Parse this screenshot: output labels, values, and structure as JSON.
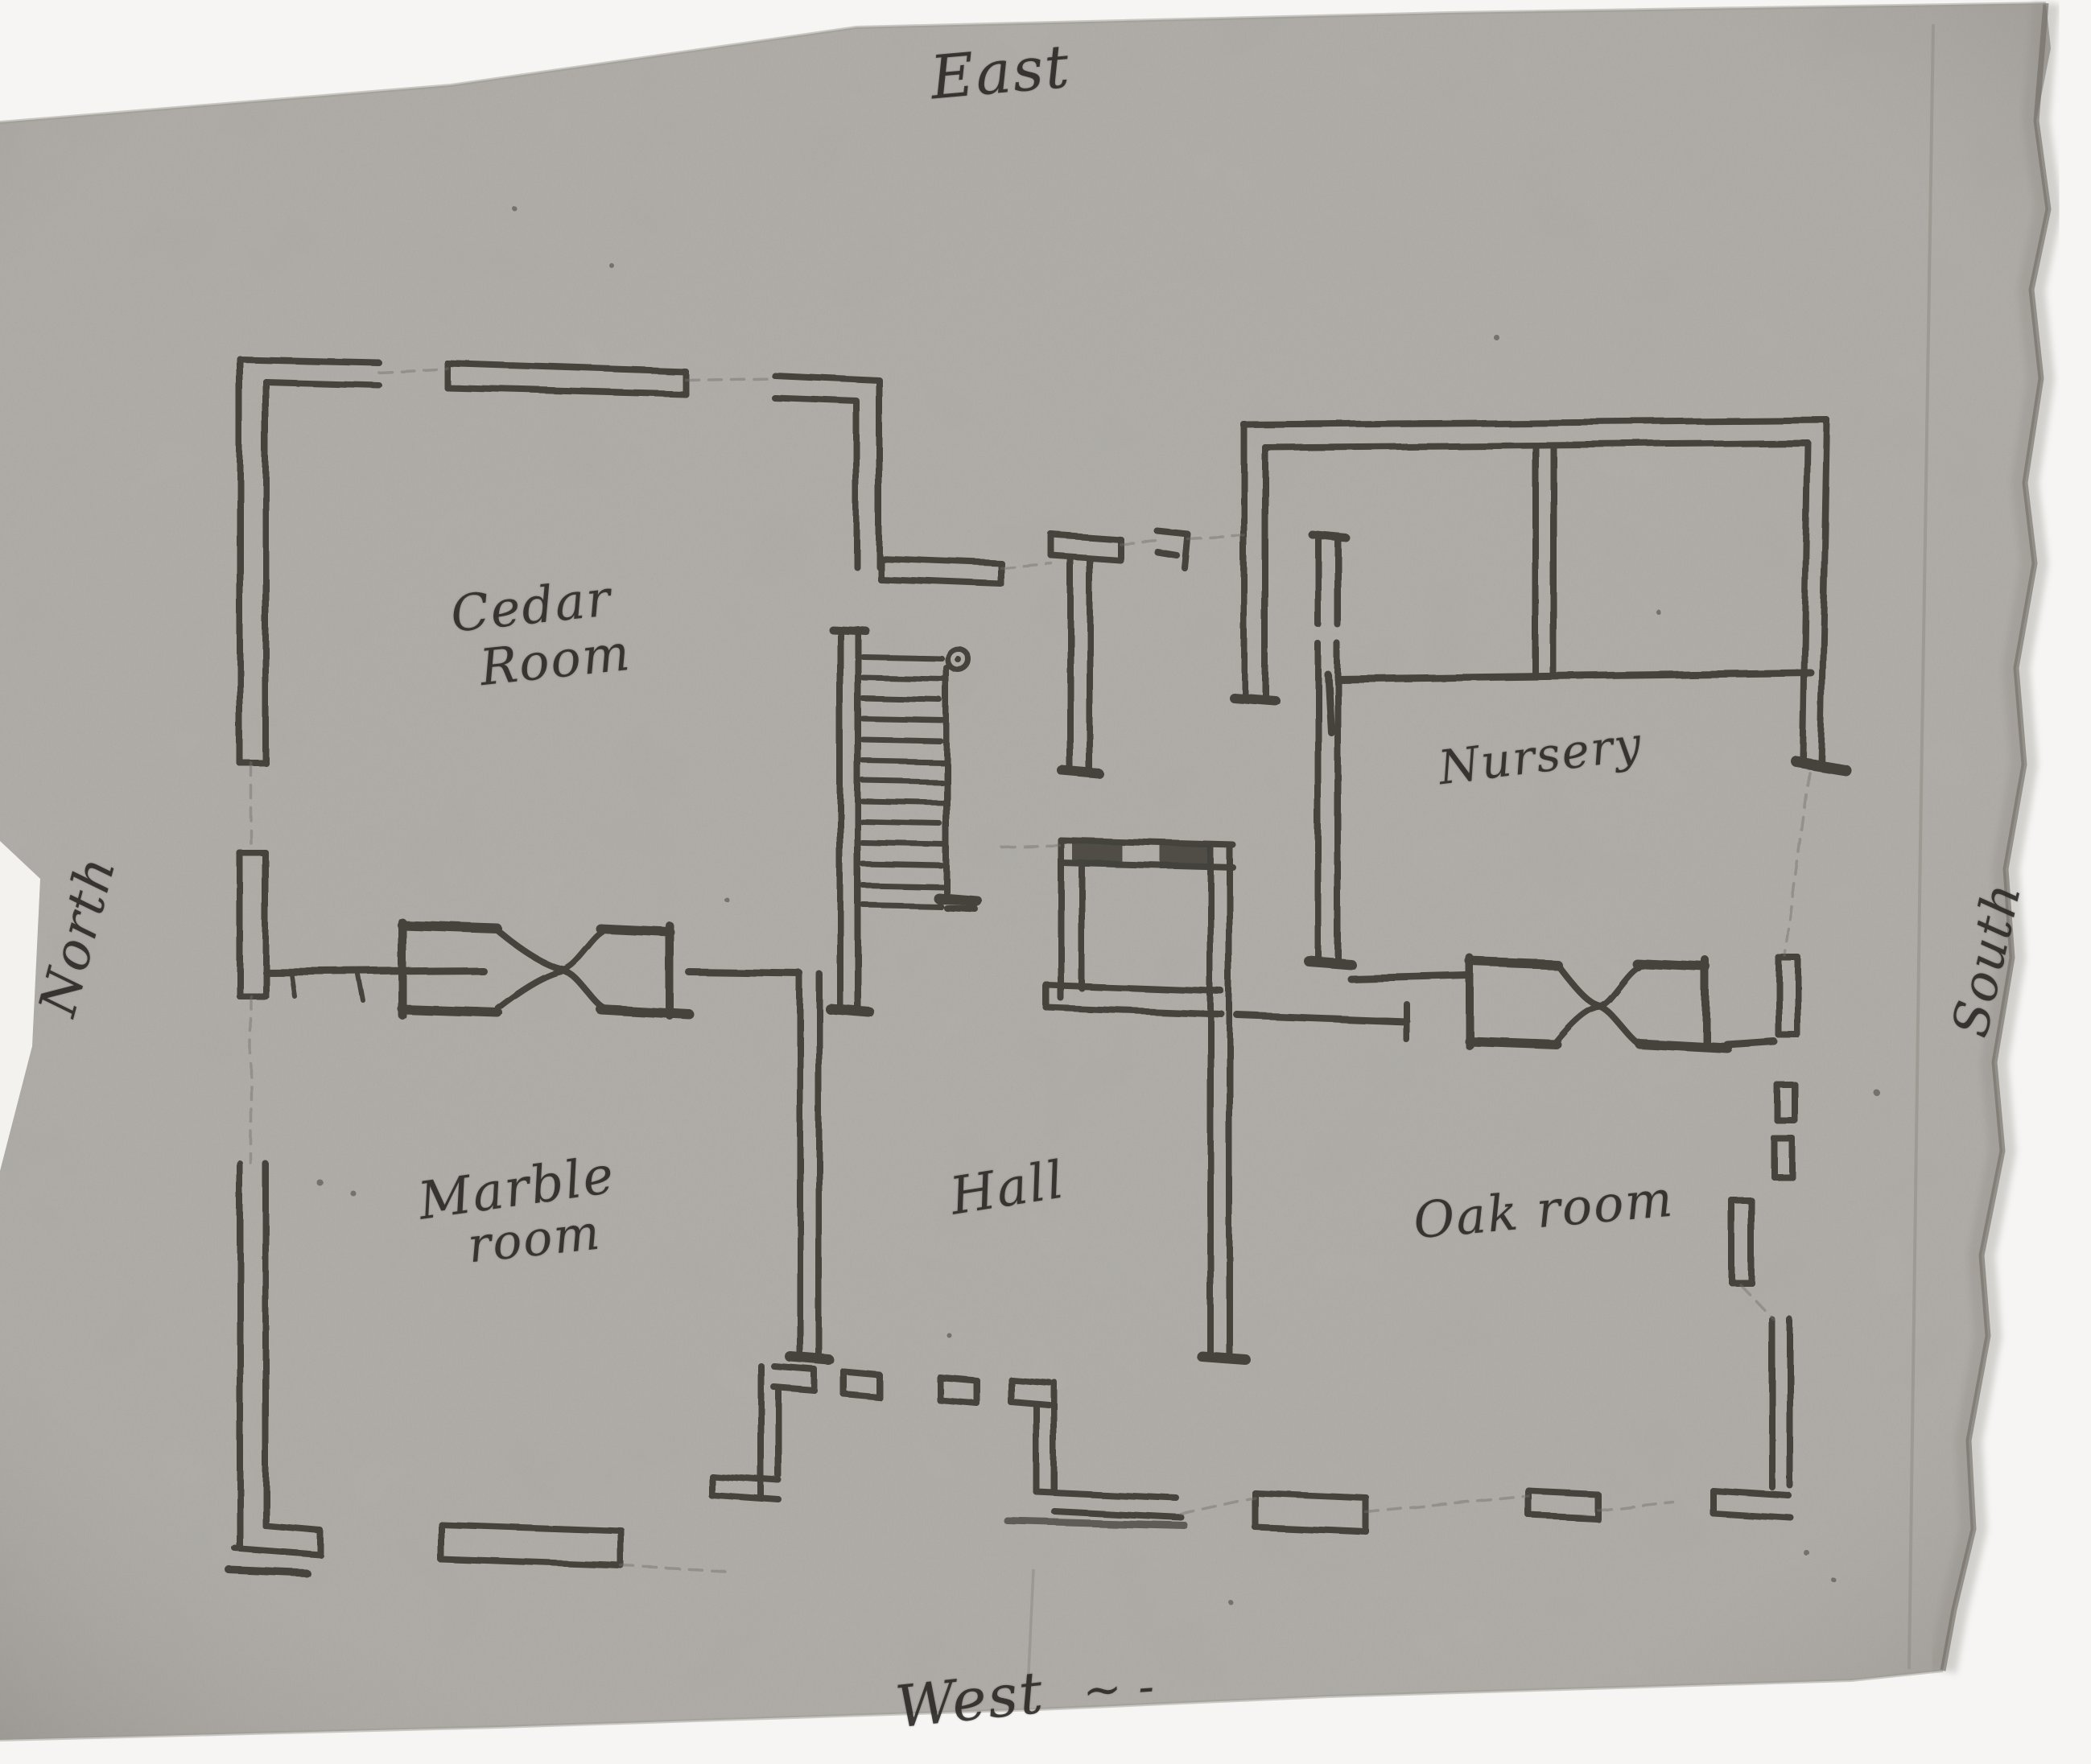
{
  "document": {
    "title": "Hand-drawn first-floor plan sketch",
    "compass": {
      "east": "East",
      "west": "West",
      "west_flourish": "~ -",
      "north": "North",
      "south": "South"
    },
    "rooms": {
      "cedar": {
        "line1": "Cedar",
        "line2": "Room"
      },
      "marble": {
        "line1": "Marble",
        "line2": "room"
      },
      "hall": {
        "label": "Hall"
      },
      "nursery": {
        "label": "Nursery"
      },
      "oak": {
        "label": "Oak room"
      }
    },
    "colors": {
      "paper": "#b4b1ac",
      "ink": "#3a3732",
      "pencil": "#6e6a63",
      "background": "#f3f2ef",
      "torn_edge": "#716d66"
    }
  }
}
